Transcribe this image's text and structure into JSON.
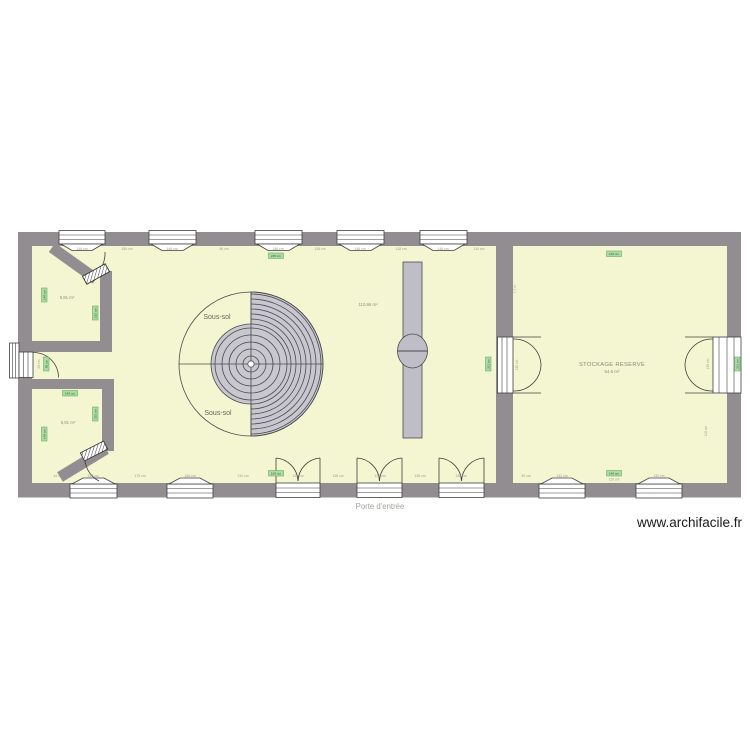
{
  "plan": {
    "watermark": "www.archifacile.fr",
    "entrance_label": "Porte d'entrée",
    "rooms": {
      "room_top_left": {
        "area": "5,91 m²"
      },
      "room_bottom_left": {
        "area": "5,91 m²"
      },
      "main_room": {
        "area": "110,96 m²",
        "level_label_top": "Sous-sol",
        "level_label_bottom": "Sous-sol"
      },
      "storage_room": {
        "name": "STOCKAGE RESERVE",
        "area": "54,6 m²"
      }
    },
    "dims": {
      "top": [
        "146 cm",
        "150 cm",
        "146 cm",
        "98 cm",
        "146 cm",
        "126 cm",
        "146 cm",
        "128 cm",
        "146 cm",
        "110 cm"
      ],
      "bottom": [
        "44 cm",
        "146 cm",
        "175 cm",
        "146 cm",
        "210 cm",
        "138 cm",
        "128 cm",
        "138 cm",
        "126 cm",
        "138 cm"
      ],
      "storage_bottom": [
        "90 cm",
        "132 cm",
        "110 cm",
        "132 cm"
      ],
      "vertical": {
        "storage_left_height": "7,7 m",
        "storage_door_left": "138 cm",
        "storage_door_right": "138 cm",
        "storage_right_lower": "110 cm",
        "hall_door": "85 cm"
      }
    },
    "chips": {
      "room1_left": "148 cm",
      "room1_right": "232 cm",
      "hall_door": "85 cm",
      "room2_top": "140 cm",
      "room2_right": "232 cm",
      "room2_left": "148 cm",
      "main_top": "235 cm",
      "main_bottom": "105 cm",
      "main_right": "311 cm",
      "storage_top": "140 cm",
      "storage_bottom": "140 cm",
      "outer_right": "311 cm"
    },
    "colors": {
      "wall": "#918d91",
      "room_fill": "#f3f6d0",
      "stair_fill": "#c9c7ce",
      "chip_fill": "#aedaa6",
      "chip_border": "#55a055",
      "chip_text": "#256b25"
    }
  }
}
